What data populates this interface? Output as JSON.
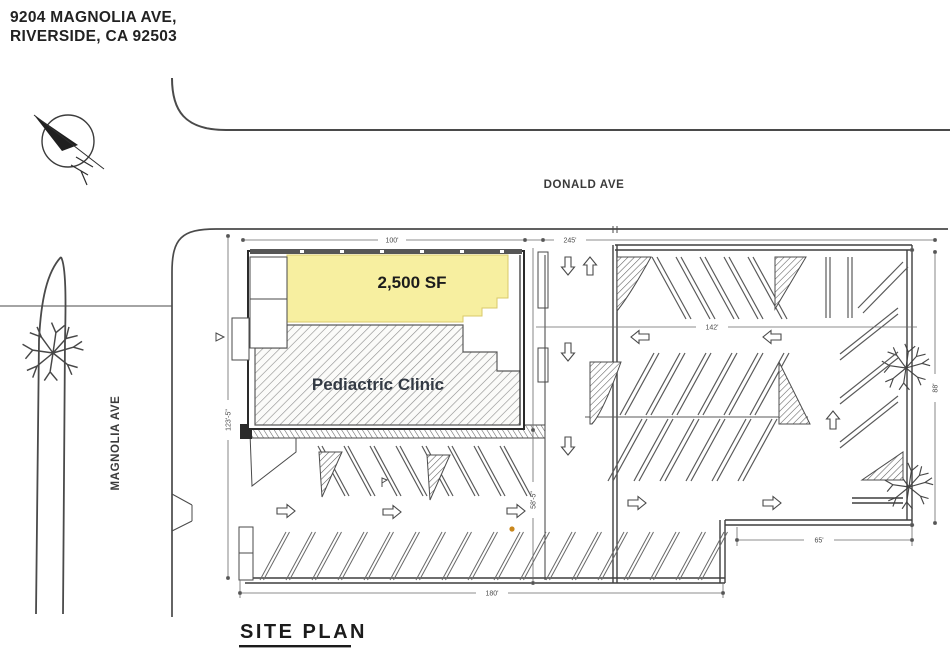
{
  "address": {
    "line1": "9204 MAGNOLIA AVE,",
    "line2": "RIVERSIDE, CA 92503"
  },
  "streets": {
    "top_label": "DONALD AVE",
    "left_label": "MAGNOLIA AVE"
  },
  "building": {
    "area_label": "2,500 SF",
    "tenant_label": "Pediactric Clinic"
  },
  "dimensions": {
    "donald_frontage": "245'",
    "building_width": "100'",
    "upper_aisle": "142'",
    "lower_width": "180'",
    "lower_right_width": "65'",
    "west_depth": "123'-5\"",
    "mid_depth": "58'-5\"",
    "east_depth": "88'"
  },
  "caption": "SITE PLAN",
  "icons": {
    "north_arrow": "north-arrow-icon",
    "tree": "tree-icon",
    "traffic_arrow": "traffic-arrow-icon"
  },
  "colors": {
    "highlight": "#f7efa0",
    "ink": "#3a3a3a",
    "paper": "#ffffff",
    "marker_dot": "#c9871d"
  }
}
